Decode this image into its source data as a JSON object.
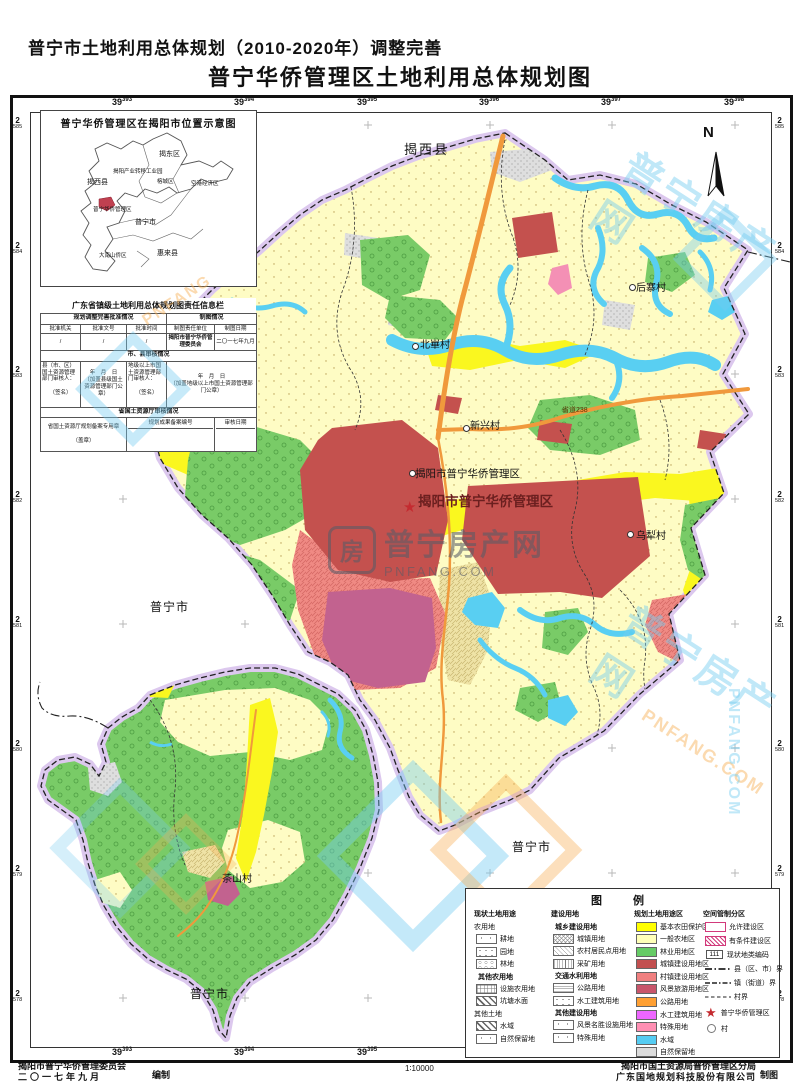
{
  "title": {
    "line1": "普宁市土地利用总体规划（2010-2020年）调整完善",
    "line2": "普宁华侨管理区土地利用总体规划图"
  },
  "grid": {
    "x_base": "39",
    "x": [
      "393",
      "394",
      "395",
      "396",
      "397",
      "398"
    ],
    "y_base": "2",
    "y": [
      "585",
      "584",
      "583",
      "582",
      "581",
      "580",
      "579",
      "578"
    ]
  },
  "inset": {
    "title": "普宁华侨管理区在揭阳市位置示意图",
    "labels": [
      "揭东区",
      "揭阳产业转移工业园",
      "揭西县",
      "榕城区",
      "空港经济区",
      "普宁华侨管理区",
      "普宁市",
      "大南山侨区",
      "惠来县"
    ]
  },
  "info_table": {
    "title": "广东省镇级土地利用总体规划图责任信息栏",
    "sec_approve": "规划调整完善批准情况",
    "sec_mapping": "制图情况",
    "col_organ": "批准机关",
    "col_doc": "批准文号",
    "col_time": "批准时间",
    "col_unit": "制图责任单位",
    "col_date": "制图日期",
    "val_organ": "/",
    "val_doc": "/",
    "val_time": "/",
    "val_unit": "揭阳市普宁华侨管理委员会",
    "val_date": "二〇一七年九月",
    "sec_city": "市、县审核情况",
    "county_reviewer": "县（市、区）国土资源管理部门审核人：",
    "city_reviewer": "地级以上市国土资源管理部门审核人：",
    "sign": "（签名）",
    "ymd": "年　月　日",
    "county_seal": "（加盖县级国土资源管理部门公章）",
    "city_seal": "（加盖地级以上市国土资源管理部门公章）",
    "sec_province": "省国土资源厅审核情况",
    "province_seal": "省国土资源厅规划备案专用章",
    "stamp": "（盖章）",
    "record_no": "规划成果备案编号",
    "review_date": "审核日期"
  },
  "map": {
    "north": "N",
    "star": "★",
    "labels": [
      "揭西县",
      "后寨村",
      "北崋村",
      "新兴村",
      "省道238",
      "揭阳市普宁华侨管理区",
      "揭阳市普宁华侨管理区",
      "乌犁村",
      "普宁市",
      "普宁市",
      "普宁市",
      "茶山村"
    ]
  },
  "legend": {
    "title": "图　例",
    "col1": {
      "header": "现状土地用途",
      "g1": "农用地",
      "g1_items": [
        "耕地",
        "园地",
        "林地"
      ],
      "g2": "其他农用地",
      "g2_items": [
        "设施农用地",
        "坑塘水面"
      ],
      "g3": "其他土地",
      "g3_items": [
        "水域",
        "自然保留地"
      ]
    },
    "col2": {
      "header": "建设用地",
      "g1": "城乡建设用地",
      "g1_items": [
        "城镇用地",
        "农村居民点用地",
        "采矿用地"
      ],
      "g2": "交通水利用地",
      "g2_items": [
        "公路用地",
        "水工建筑用地"
      ],
      "g3": "其他建设用地",
      "g3_items": [
        "风景名胜设施用地",
        "特殊用地"
      ]
    },
    "col3": {
      "header": "规划土地用途区",
      "items": [
        {
          "label": "基本农田保护区",
          "color": "#FFFF00"
        },
        {
          "label": "一般农地区",
          "color": "#FFFFB8"
        },
        {
          "label": "林业用地区",
          "color": "#66CC66"
        },
        {
          "label": "城镇建设用地区",
          "color": "#C24F4F"
        },
        {
          "label": "村镇建设用地区",
          "color": "#F08080"
        },
        {
          "label": "风景旅游用地区",
          "color": "#C9566B"
        },
        {
          "label": "公路用地",
          "color": "#FFA033"
        },
        {
          "label": "水工建筑用地",
          "color": "#EE66FF"
        },
        {
          "label": "特殊用地",
          "color": "#FF8FB3"
        },
        {
          "label": "水域",
          "color": "#55CCF2"
        },
        {
          "label": "自然保留地",
          "color": "#DCDCDC"
        }
      ]
    },
    "col4": {
      "header": "空间管制分区",
      "allowed": "允许建设区",
      "conditional": "有条件建设区",
      "code": "111",
      "code_label": "现状地类编码",
      "county": "县（区、市）界",
      "town": "镇（街道）界",
      "village": "村界",
      "district": "普宁华侨管理区",
      "village_pt": "村"
    }
  },
  "footer": {
    "left_org": "揭阳市普宁华侨管理委员会",
    "left_date": "二〇一七年九月",
    "left_role": "编制",
    "scale": "1∶10000",
    "right_org1": "揭阳市国土资源局普侨管理区分局",
    "right_org2": "广东国地规划科技股份有限公司",
    "right_role": "制图"
  },
  "watermark": {
    "name": "普宁房产网",
    "domain": "PNFANG.COM",
    "short": "PNFANG",
    "glyph": "房"
  }
}
